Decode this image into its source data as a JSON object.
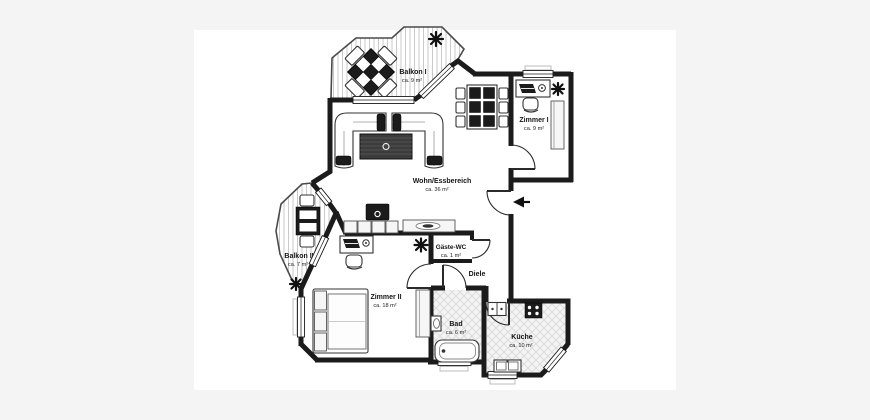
{
  "plan": {
    "title": "Apartment floor plan",
    "rooms": [
      {
        "name": "Balkon I",
        "area": "ca. 9 m²"
      },
      {
        "name": "Zimmer I",
        "area": "ca. 9 m²"
      },
      {
        "name": "Wohn/Essbereich",
        "area": "ca. 36 m²"
      },
      {
        "name": "Balkon II",
        "area": "ca. 7 m²"
      },
      {
        "name": "Gäste-WC",
        "area": "ca. 1 m²"
      },
      {
        "name": "Diele",
        "area": ""
      },
      {
        "name": "Zimmer II",
        "area": "ca. 18 m²"
      },
      {
        "name": "Bad",
        "area": "ca. 6 m²"
      },
      {
        "name": "Küche",
        "area": "ca. 10 m²"
      }
    ],
    "colors": {
      "background": "#f4f4f5",
      "paper": "#ffffff",
      "wall": "#1b1b1b",
      "deck_stripe": "#c9c9c9",
      "tile_stripe": "#d8d8d8"
    }
  }
}
